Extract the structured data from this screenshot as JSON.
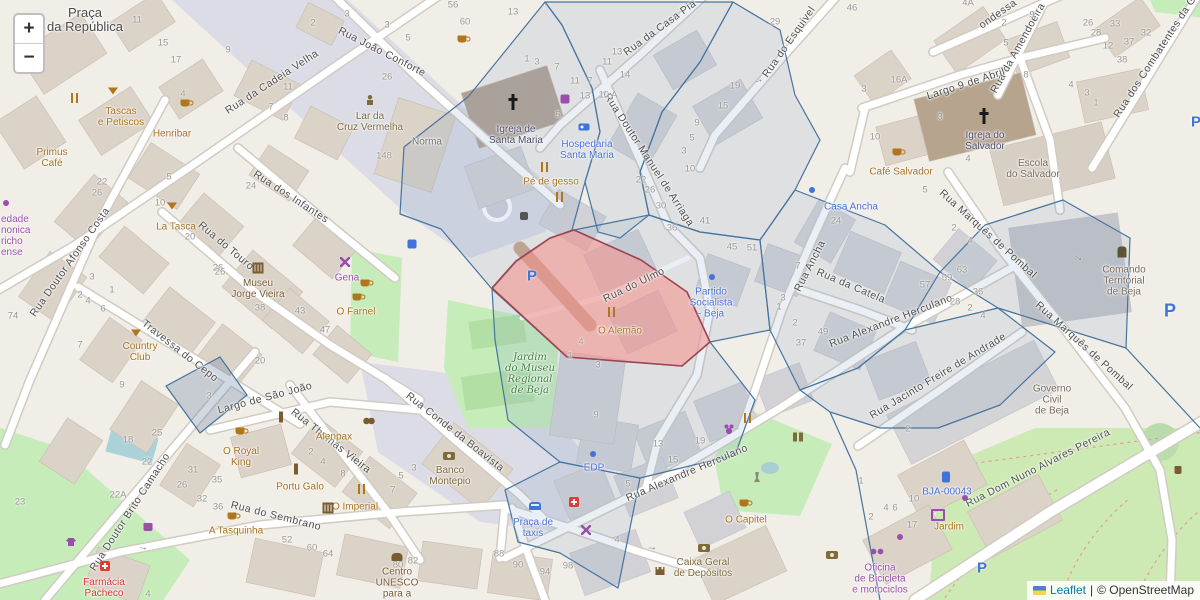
{
  "controls": {
    "zoom_in": "+",
    "zoom_out": "−"
  },
  "attribution": {
    "leaflet": "Leaflet",
    "separator": "|",
    "copyright": "© OpenStreetMap"
  },
  "colors": {
    "accent_blue_polygon": "#46749f",
    "highlight_red_fill": "#e98f8f",
    "highlight_red_stroke": "#9e4455",
    "poi_amenity": "#a8731e",
    "poi_shop": "#9a4fae",
    "poi_blue": "#4a70d6",
    "poi_red": "#d8362e",
    "park_label": "#3e7f3f",
    "parking_letter": "#3f74d9"
  },
  "map": {
    "streets": [
      [
        "Rua da Cadeia Velha",
        272,
        82,
        -33
      ],
      [
        "Rua João Conforte",
        382,
        52,
        27
      ],
      [
        "Rua da Casa Pia",
        660,
        28,
        -36
      ],
      [
        "Rua do Esquivel",
        789,
        42,
        -55
      ],
      [
        "ondessa",
        998,
        14,
        -35
      ],
      [
        "Rua da Amendoeira",
        1018,
        48,
        -61
      ],
      [
        "Largo 9 de Abril",
        966,
        84,
        -18
      ],
      [
        "Rua dos Combatentes da G",
        1155,
        57,
        -57
      ],
      [
        "Rua Doutor Manuel de Arriaga",
        649,
        160,
        57
      ],
      [
        "Rua dos Infantes",
        291,
        197,
        33
      ],
      [
        "Rua Doutor Afonso Costa",
        70,
        262,
        -55
      ],
      [
        "Rua do Touro",
        226,
        246,
        40
      ],
      [
        "Travessa do Cepo",
        180,
        351,
        38
      ],
      [
        "Largo de São João",
        265,
        398,
        -15
      ],
      [
        "Rua Thomás Vieira",
        331,
        441,
        38
      ],
      [
        "Rua Conde da Boavista",
        455,
        432,
        38
      ],
      [
        "Rua do Sembrano",
        276,
        516,
        14
      ],
      [
        "Rua Doutor Brito Camacho",
        130,
        512,
        -57
      ],
      [
        "Rua Alexandre Herculano",
        687,
        473,
        -23
      ],
      [
        "Rua Alexandre Herculano",
        891,
        321,
        -21
      ],
      [
        "Rua Ancha",
        810,
        266,
        -63
      ],
      [
        "Rua da Catela",
        851,
        286,
        23
      ],
      [
        "Rua Marquês de Pombal",
        988,
        234,
        42
      ],
      [
        "Rua Marquês de Pombal",
        1084,
        346,
        42
      ],
      [
        "Rua Jacinto Freire de Andrade",
        938,
        376,
        -31
      ],
      [
        "Rua Dom Nuno Alvares Pereira",
        1038,
        468,
        -27
      ],
      [
        "Rua do Ulmo",
        634,
        285,
        -26
      ]
    ],
    "pois": [
      {
        "l": [
          "Praça",
          "da República"
        ],
        "x": 85,
        "y": 20,
        "c": "big"
      },
      {
        "l": [
          "Primus",
          "Café"
        ],
        "x": 52,
        "y": 158,
        "c": "am"
      },
      {
        "l": [
          "Tascas",
          "e Petiscos"
        ],
        "x": 121,
        "y": 117,
        "c": "am"
      },
      {
        "l": [
          "Henribar"
        ],
        "x": 172,
        "y": 134,
        "c": "am"
      },
      {
        "l": [
          "Lar da",
          "Cruz Vermelha"
        ],
        "x": 370,
        "y": 122,
        "c": "ol"
      },
      {
        "l": [
          "La Tasca"
        ],
        "x": 176,
        "y": 227,
        "c": "am"
      },
      {
        "l": [
          "Gena"
        ],
        "x": 347,
        "y": 278,
        "c": "sh"
      },
      {
        "l": [
          "O Farnel"
        ],
        "x": 356,
        "y": 312,
        "c": "am"
      },
      {
        "l": [
          "Country",
          "Club"
        ],
        "x": 140,
        "y": 352,
        "c": "am"
      },
      {
        "l": [
          "Museu",
          "Jorge Vieira"
        ],
        "x": 258,
        "y": 289,
        "c": "br"
      },
      {
        "l": [
          "O Imperial"
        ],
        "x": 355,
        "y": 507,
        "c": "am"
      },
      {
        "l": [
          "Portu Galo"
        ],
        "x": 300,
        "y": 487,
        "c": "am"
      },
      {
        "l": [
          "Alenpax"
        ],
        "x": 334,
        "y": 437,
        "c": "am"
      },
      {
        "l": [
          "O Royal",
          "King"
        ],
        "x": 241,
        "y": 457,
        "c": "am"
      },
      {
        "l": [
          "A Tasquinha"
        ],
        "x": 236,
        "y": 531,
        "c": "am"
      },
      {
        "l": [
          "Farmácia",
          "Pacheco"
        ],
        "x": 104,
        "y": 588,
        "c": "rd"
      },
      {
        "l": [
          "O Alemão"
        ],
        "x": 620,
        "y": 331,
        "c": "am"
      },
      {
        "l": [
          "Café Salvador"
        ],
        "x": 901,
        "y": 172,
        "c": "am"
      },
      {
        "l": [
          "Casa Ancha"
        ],
        "x": 851,
        "y": 207,
        "c": "bl"
      },
      {
        "l": [
          "Hospedaria",
          "Santa Maria"
        ],
        "x": 587,
        "y": 150,
        "c": "bl"
      },
      {
        "l": [
          "Pé de gesso"
        ],
        "x": 551,
        "y": 182,
        "c": "am"
      },
      {
        "l": [
          "Partido",
          "Socialista",
          "- Beja"
        ],
        "x": 711,
        "y": 303,
        "c": "bl"
      },
      {
        "l": [
          "EDP"
        ],
        "x": 594,
        "y": 468,
        "c": "bl"
      },
      {
        "l": [
          "Praça de",
          "taxis"
        ],
        "x": 533,
        "y": 528,
        "c": "bl"
      },
      {
        "l": [
          "BJA-00043"
        ],
        "x": 947,
        "y": 492,
        "c": "bl"
      },
      {
        "l": [
          "Jardim"
        ],
        "x": 949,
        "y": 527,
        "c": "am"
      },
      {
        "l": [
          "Oficina",
          "de Bicicleta",
          "e motociclos"
        ],
        "x": 880,
        "y": 579,
        "c": "sh"
      },
      {
        "l": [
          "Centro",
          "UNESCO",
          "para a"
        ],
        "x": 397,
        "y": 583,
        "c": "br"
      },
      {
        "l": [
          "Caixa Geral",
          "de Depósitos"
        ],
        "x": 703,
        "y": 568,
        "c": "ol"
      },
      {
        "l": [
          "Banco",
          "Montepio"
        ],
        "x": 450,
        "y": 476,
        "c": "ol"
      },
      {
        "l": [
          "Jardim",
          "do Museu",
          "Regional",
          "de Beja"
        ],
        "x": 530,
        "y": 374,
        "c": "gr"
      },
      {
        "l": [
          "Igreja de",
          "Santa Maria"
        ],
        "x": 516,
        "y": 135,
        "c": "ch"
      },
      {
        "l": [
          "Igreja do",
          "Salvador"
        ],
        "x": 985,
        "y": 141,
        "c": "ch"
      },
      {
        "l": [
          "Escola",
          "do Salvador"
        ],
        "x": 1033,
        "y": 169,
        "c": "cv"
      },
      {
        "l": [
          "Comando",
          "Territorial",
          "de Beja"
        ],
        "x": 1124,
        "y": 281,
        "c": "cv"
      },
      {
        "l": [
          "Governo",
          "Civil",
          "de Beja"
        ],
        "x": 1052,
        "y": 400,
        "c": "cv"
      },
      {
        "l": [
          "O Capitel"
        ],
        "x": 746,
        "y": 520,
        "c": "am"
      },
      {
        "l": [
          "Norma"
        ],
        "x": 427,
        "y": 142,
        "c": "gy"
      },
      {
        "l": [
          "edade",
          "nonica",
          "richo",
          "ense"
        ],
        "x": 1,
        "y": 236,
        "c": "sh",
        "a": 1
      }
    ],
    "numbers": [
      [
        "11",
        137,
        20
      ],
      [
        "15",
        163,
        43
      ],
      [
        "17",
        176,
        60
      ],
      [
        "9",
        228,
        50
      ],
      [
        "2",
        313,
        23
      ],
      [
        "3",
        347,
        14
      ],
      [
        "3",
        387,
        25
      ],
      [
        "5",
        408,
        38
      ],
      [
        "11",
        288,
        87
      ],
      [
        "7",
        271,
        107
      ],
      [
        "8",
        286,
        118
      ],
      [
        "26",
        387,
        77
      ],
      [
        "56",
        453,
        5
      ],
      [
        "60",
        465,
        22
      ],
      [
        "148",
        384,
        156
      ],
      [
        "4",
        183,
        94
      ],
      [
        "13",
        513,
        12
      ],
      [
        "1",
        527,
        59
      ],
      [
        "3",
        537,
        62
      ],
      [
        "7",
        557,
        67
      ],
      [
        "11",
        575,
        81
      ],
      [
        "7",
        590,
        81
      ],
      [
        "13",
        585,
        96
      ],
      [
        "10 A",
        608,
        95
      ],
      [
        "5",
        558,
        115
      ],
      [
        "22",
        641,
        180
      ],
      [
        "26",
        650,
        190
      ],
      [
        "30",
        661,
        206
      ],
      [
        "9",
        697,
        123
      ],
      [
        "5",
        692,
        138
      ],
      [
        "3",
        684,
        151
      ],
      [
        "10",
        690,
        169
      ],
      [
        "29",
        775,
        22
      ],
      [
        "46",
        852,
        8
      ],
      [
        "13",
        617,
        52
      ],
      [
        "11",
        607,
        62
      ],
      [
        "14",
        625,
        75
      ],
      [
        "19",
        735,
        86
      ],
      [
        "15",
        723,
        106
      ],
      [
        "4A",
        968,
        3
      ],
      [
        "9",
        1032,
        15
      ],
      [
        "2",
        1004,
        23
      ],
      [
        "5",
        1006,
        43
      ],
      [
        "26",
        1088,
        23
      ],
      [
        "28",
        1096,
        33
      ],
      [
        "33",
        1115,
        24
      ],
      [
        "32",
        1146,
        33
      ],
      [
        "37",
        1129,
        42
      ],
      [
        "12",
        1108,
        46
      ],
      [
        "38",
        1122,
        60
      ],
      [
        "8",
        1026,
        75
      ],
      [
        "4",
        1071,
        85
      ],
      [
        "3",
        1087,
        93
      ],
      [
        "1",
        1096,
        103
      ],
      [
        "16A",
        899,
        80
      ],
      [
        "3",
        864,
        89
      ],
      [
        "10",
        875,
        137
      ],
      [
        "3",
        940,
        117
      ],
      [
        "4",
        968,
        159
      ],
      [
        "36",
        672,
        228
      ],
      [
        "41",
        705,
        221
      ],
      [
        "45",
        732,
        247
      ],
      [
        "4",
        581,
        342
      ],
      [
        "1",
        570,
        356
      ],
      [
        "3",
        598,
        365
      ],
      [
        "24",
        836,
        221
      ],
      [
        "51",
        752,
        248
      ],
      [
        "5",
        925,
        190
      ],
      [
        "2",
        954,
        228
      ],
      [
        "4",
        970,
        241
      ],
      [
        "7",
        798,
        266
      ],
      [
        "3",
        783,
        298
      ],
      [
        "1",
        779,
        307
      ],
      [
        "2",
        795,
        323
      ],
      [
        "49",
        823,
        332
      ],
      [
        "37",
        801,
        343
      ],
      [
        "57",
        925,
        285
      ],
      [
        "59",
        947,
        278
      ],
      [
        "63",
        962,
        270
      ],
      [
        "36",
        978,
        292
      ],
      [
        "28",
        955,
        302
      ],
      [
        "2",
        970,
        308
      ],
      [
        "4",
        983,
        316
      ],
      [
        "22",
        102,
        182
      ],
      [
        "26",
        97,
        193
      ],
      [
        "5",
        169,
        177
      ],
      [
        "10",
        160,
        203
      ],
      [
        "20",
        190,
        237
      ],
      [
        "24",
        251,
        186
      ],
      [
        "26",
        218,
        268
      ],
      [
        "74",
        13,
        316
      ],
      [
        "3",
        92,
        277
      ],
      [
        "2",
        80,
        295
      ],
      [
        "4",
        88,
        301
      ],
      [
        "6",
        103,
        309
      ],
      [
        "1",
        112,
        290
      ],
      [
        "7",
        80,
        345
      ],
      [
        "26",
        220,
        272
      ],
      [
        "38",
        260,
        308
      ],
      [
        "43",
        300,
        311
      ],
      [
        "47",
        325,
        330
      ],
      [
        "20",
        260,
        361
      ],
      [
        "3",
        209,
        396
      ],
      [
        "9",
        122,
        385
      ],
      [
        "25",
        157,
        433
      ],
      [
        "18",
        128,
        440
      ],
      [
        "22",
        147,
        462
      ],
      [
        "22A",
        118,
        495
      ],
      [
        "23",
        20,
        502
      ],
      [
        "31",
        193,
        470
      ],
      [
        "35",
        217,
        480
      ],
      [
        "26",
        182,
        485
      ],
      [
        "32",
        202,
        499
      ],
      [
        "36",
        218,
        507
      ],
      [
        "4",
        148,
        594
      ],
      [
        "2",
        311,
        452
      ],
      [
        "4",
        323,
        462
      ],
      [
        "8",
        343,
        474
      ],
      [
        "3",
        414,
        468
      ],
      [
        "5",
        401,
        476
      ],
      [
        "7",
        393,
        490
      ],
      [
        "52",
        287,
        540
      ],
      [
        "60",
        312,
        548
      ],
      [
        "64",
        328,
        554
      ],
      [
        "80",
        398,
        565
      ],
      [
        "82",
        413,
        561
      ],
      [
        "88",
        499,
        554
      ],
      [
        "90",
        518,
        565
      ],
      [
        "94",
        545,
        572
      ],
      [
        "98",
        568,
        566
      ],
      [
        "9",
        596,
        415
      ],
      [
        "13",
        658,
        444
      ],
      [
        "19",
        700,
        441
      ],
      [
        "15",
        673,
        460
      ],
      [
        "5",
        628,
        484
      ],
      [
        "4",
        617,
        540
      ],
      [
        "2",
        908,
        429
      ],
      [
        "1",
        861,
        481
      ],
      [
        "10",
        914,
        499
      ],
      [
        "4",
        886,
        508
      ],
      [
        "6",
        895,
        508
      ],
      [
        "17",
        912,
        525
      ],
      [
        "2",
        871,
        517
      ]
    ],
    "parking_letters": [
      [
        532,
        276,
        15
      ],
      [
        1170,
        311,
        18
      ],
      [
        982,
        568,
        15
      ],
      [
        1196,
        122,
        15
      ]
    ],
    "icons": [
      [
        "cup",
        185,
        103
      ],
      [
        "cup",
        462,
        39
      ],
      [
        "cup",
        897,
        152
      ],
      [
        "cup",
        232,
        516
      ],
      [
        "cup",
        744,
        503
      ],
      [
        "cup",
        357,
        297
      ],
      [
        "cup",
        365,
        283
      ],
      [
        "cup",
        240,
        431
      ],
      [
        "fork",
        75,
        98
      ],
      [
        "fork",
        545,
        167
      ],
      [
        "fork",
        560,
        197
      ],
      [
        "fork",
        612,
        312
      ],
      [
        "fork",
        362,
        489
      ],
      [
        "fork",
        748,
        418
      ],
      [
        "martini",
        113,
        91
      ],
      [
        "martini",
        172,
        206
      ],
      [
        "martini",
        136,
        333
      ],
      [
        "cross",
        513,
        102
      ],
      [
        "cross",
        984,
        116
      ],
      [
        "crossred",
        105,
        566
      ],
      [
        "crossred",
        574,
        502
      ],
      [
        "museum",
        258,
        268
      ],
      [
        "museum",
        328,
        508
      ],
      [
        "masks",
        369,
        421
      ],
      [
        "column",
        281,
        417
      ],
      [
        "column",
        296,
        469
      ],
      [
        "statue",
        757,
        477
      ],
      [
        "elephant",
        397,
        557
      ],
      [
        "bin",
        1178,
        470
      ],
      [
        "wc",
        798,
        437
      ],
      [
        "person",
        370,
        100
      ],
      [
        "police",
        1122,
        252
      ],
      [
        "money",
        449,
        456
      ],
      [
        "money",
        704,
        548
      ],
      [
        "money",
        832,
        555
      ],
      [
        "castle",
        660,
        571
      ],
      [
        "bed",
        584,
        127
      ],
      [
        "taxi",
        535,
        506
      ],
      [
        "charge",
        946,
        477
      ],
      [
        "tv",
        938,
        515
      ],
      [
        "bike",
        877,
        551
      ],
      [
        "scissors",
        345,
        262
      ],
      [
        "scissors",
        586,
        530
      ],
      [
        "shirt",
        71,
        542
      ],
      [
        "bag",
        148,
        527
      ],
      [
        "paw",
        729,
        429
      ],
      [
        "dotb",
        712,
        277
      ],
      [
        "dotb",
        593,
        454
      ],
      [
        "dotb",
        812,
        190
      ],
      [
        "dotp",
        965,
        498
      ],
      [
        "dotp",
        900,
        537
      ],
      [
        "dotp",
        6,
        203
      ],
      [
        "phone",
        524,
        216
      ],
      [
        "psq",
        565,
        99
      ],
      [
        "bsq",
        412,
        244
      ],
      [
        "arrow",
        758,
        80,
        -20
      ],
      [
        "arrow",
        1079,
        257,
        35
      ],
      [
        "arrow",
        652,
        547,
        5
      ],
      [
        "arrow",
        143,
        547,
        10
      ]
    ]
  }
}
